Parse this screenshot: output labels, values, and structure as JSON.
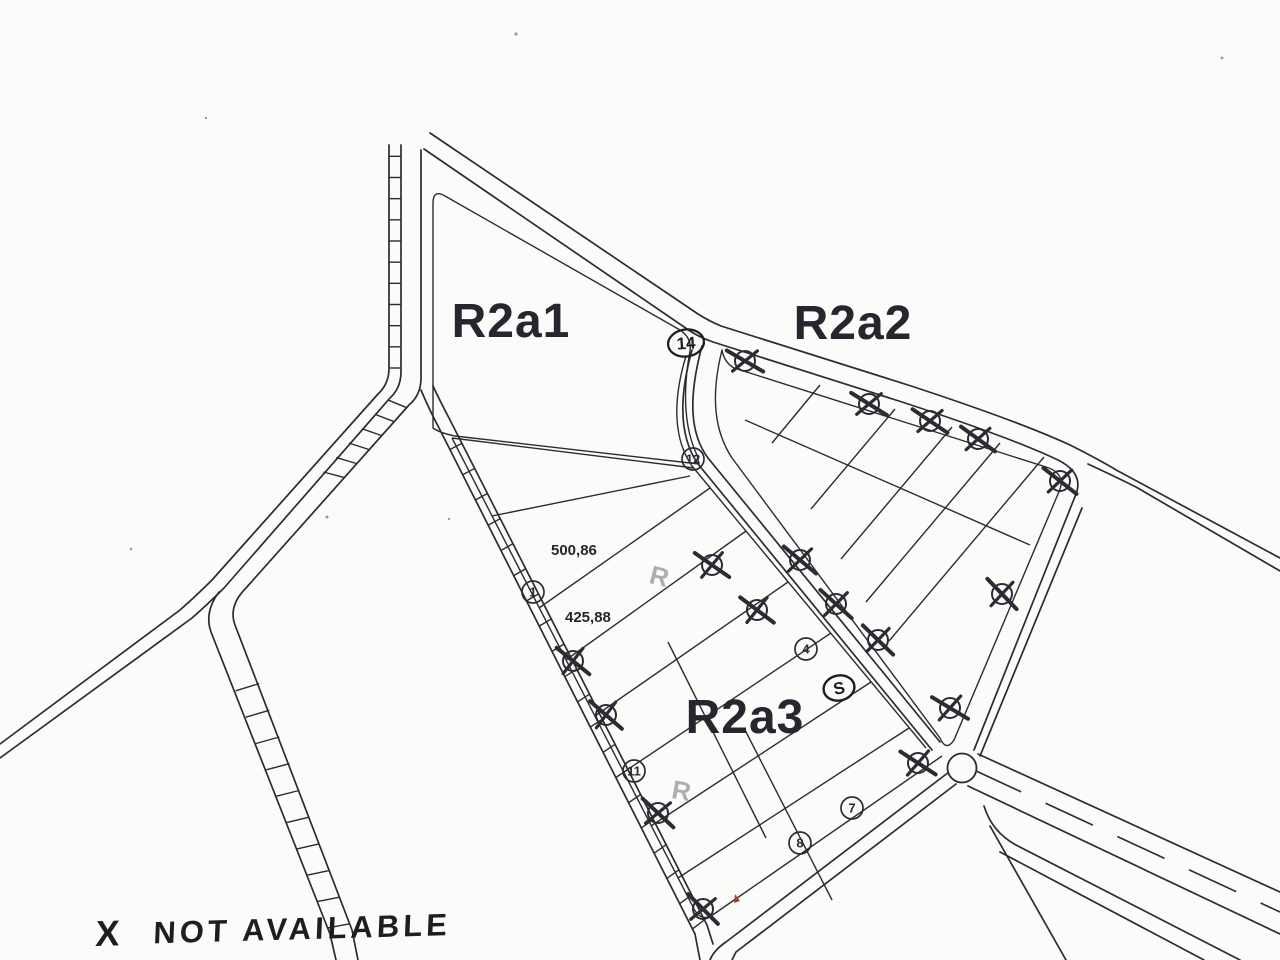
{
  "document": {
    "type": "scanned-subdivision-plan"
  },
  "zones": [
    {
      "label": "R2a1"
    },
    {
      "label": "R2a2"
    },
    {
      "label": "R2a3"
    }
  ],
  "measurements": [
    {
      "value": "500,86"
    },
    {
      "value": "425,88"
    }
  ],
  "plots": {
    "available": [
      {
        "number": "12",
        "x": 693,
        "y": 459
      },
      {
        "number": "1",
        "x": 533,
        "y": 592
      },
      {
        "number": "4",
        "x": 806,
        "y": 649
      },
      {
        "number": "11",
        "x": 634,
        "y": 771
      },
      {
        "number": "7",
        "x": 852,
        "y": 808
      },
      {
        "number": "8",
        "x": 800,
        "y": 843
      }
    ],
    "not_available": [
      {
        "x": 745,
        "y": 361
      },
      {
        "x": 869,
        "y": 404
      },
      {
        "x": 930,
        "y": 421
      },
      {
        "x": 978,
        "y": 439
      },
      {
        "x": 1060,
        "y": 481
      },
      {
        "x": 800,
        "y": 560
      },
      {
        "x": 836,
        "y": 604
      },
      {
        "x": 878,
        "y": 640
      },
      {
        "x": 1002,
        "y": 594
      },
      {
        "x": 950,
        "y": 708
      },
      {
        "x": 918,
        "y": 763
      },
      {
        "x": 712,
        "y": 565
      },
      {
        "x": 757,
        "y": 610
      },
      {
        "x": 573,
        "y": 661
      },
      {
        "x": 606,
        "y": 715
      },
      {
        "x": 658,
        "y": 813
      },
      {
        "x": 703,
        "y": 909
      }
    ]
  },
  "handwritten": {
    "circled_plot_number": "14",
    "circled_letter": "S",
    "pencil_mark_1": "R",
    "pencil_mark_2": "R",
    "legend_symbol": "X",
    "legend_text": "NOT AVAILABLE"
  },
  "colors": {
    "paper": "#fbfbf9",
    "ink": "#2b2b33",
    "pencil": "#90909a",
    "red_mark": "#b03a2e"
  }
}
